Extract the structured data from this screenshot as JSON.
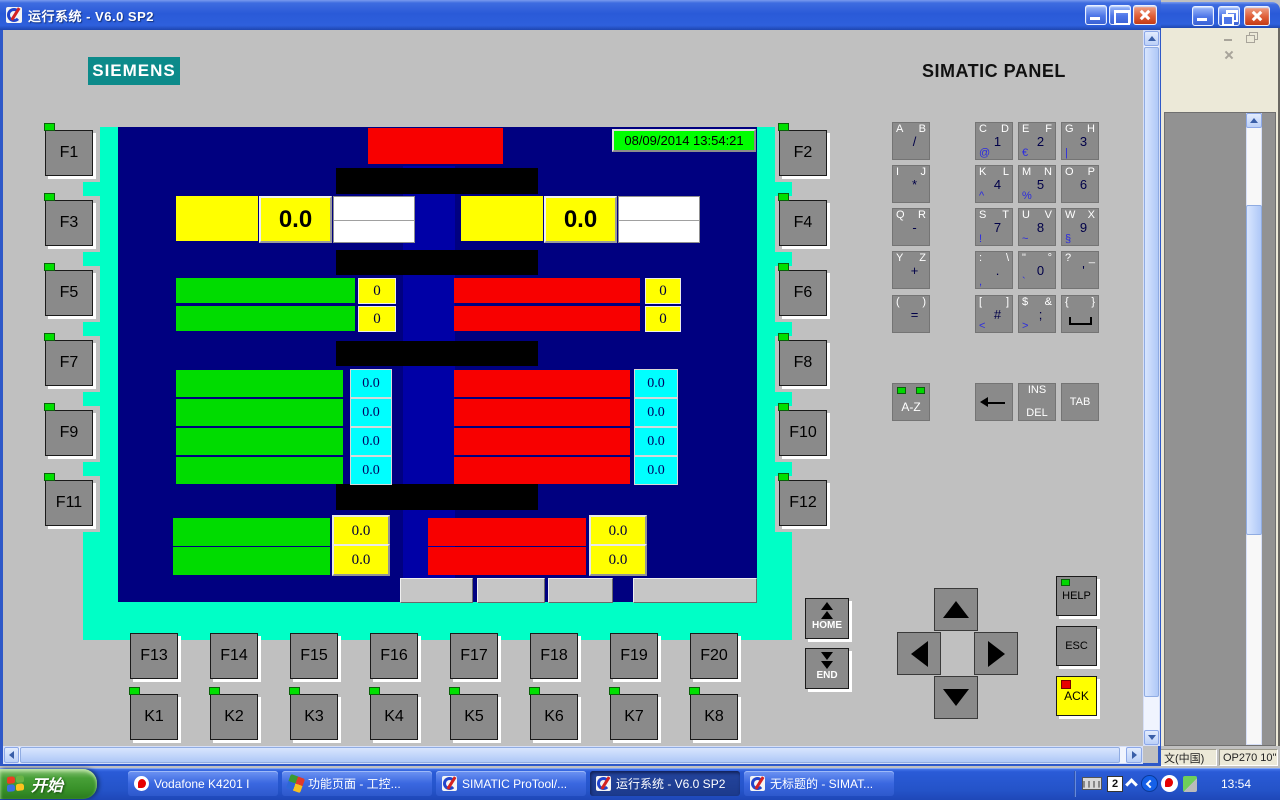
{
  "rt_window": {
    "title": "运行系统 - V6.0 SP2"
  },
  "bg_window": {
    "status_lang": "文(中国)",
    "status_device": "OP270 10\""
  },
  "header": {
    "brand": "SIEMENS",
    "panel_label": "SIMATIC PANEL"
  },
  "panel": {
    "f_left": [
      "F1",
      "F3",
      "F5",
      "F7",
      "F9",
      "F11"
    ],
    "f_right": [
      "F2",
      "F4",
      "F6",
      "F8",
      "F10",
      "F12"
    ],
    "f_bottom": [
      "F13",
      "F14",
      "F15",
      "F16",
      "F17",
      "F18",
      "F19",
      "F20"
    ],
    "k_keys": [
      "K1",
      "K2",
      "K3",
      "K4",
      "K5",
      "K6",
      "K7",
      "K8"
    ],
    "screen": {
      "datetime": "08/09/2014 13:54:21",
      "top_left_value": "0.0",
      "top_right_value": "0.0",
      "counters_left": [
        "0",
        "0"
      ],
      "counters_right": [
        "0",
        "0"
      ],
      "rates_left": [
        "0.0",
        "0.0",
        "0.0",
        "0.0"
      ],
      "rates_right": [
        "0.0",
        "0.0",
        "0.0",
        "0.0"
      ],
      "totals_left": [
        "0.0",
        "0.0"
      ],
      "totals_right": [
        "0.0",
        "0.0"
      ],
      "footer_buttons": [
        "",
        "",
        "",
        ""
      ]
    },
    "keypad": {
      "rows": [
        [
          {
            "tl": "A",
            "tr": "B",
            "mid": "/"
          },
          {
            "tl": "C",
            "tr": "D",
            "mid": "1",
            "bl": "@"
          },
          {
            "tl": "E",
            "tr": "F",
            "mid": "2",
            "bl": "€"
          },
          {
            "tl": "G",
            "tr": "H",
            "mid": "3",
            "bl": "|"
          }
        ],
        [
          {
            "tl": "I",
            "tr": "J",
            "mid": "*"
          },
          {
            "tl": "K",
            "tr": "L",
            "mid": "4",
            "bl": "^"
          },
          {
            "tl": "M",
            "tr": "N",
            "mid": "5",
            "bl": "%"
          },
          {
            "tl": "O",
            "tr": "P",
            "mid": "6"
          }
        ],
        [
          {
            "tl": "Q",
            "tr": "R",
            "mid": "-"
          },
          {
            "tl": "S",
            "tr": "T",
            "mid": "7",
            "bl": "!"
          },
          {
            "tl": "U",
            "tr": "V",
            "mid": "8",
            "bl": "~"
          },
          {
            "tl": "W",
            "tr": "X",
            "mid": "9",
            "bl": "§"
          }
        ],
        [
          {
            "tl": "Y",
            "tr": "Z",
            "mid": "+"
          },
          {
            "tl": ":",
            "tr": "\\",
            "mid": ".",
            "bl": ","
          },
          {
            "tl": "\"",
            "tr": "°",
            "mid": "0",
            "bl": "`"
          },
          {
            "tl": "?",
            "tr": "_",
            "mid": "'"
          }
        ],
        [
          {
            "tl": "(",
            "tr": ")",
            "mid": "="
          },
          {
            "tl": "[",
            "tr": "]",
            "mid": "#",
            "bl": "<"
          },
          {
            "tl": "$",
            "tr": "&",
            "mid": ";",
            "bl": ">"
          },
          {
            "tl": "{",
            "tr": "}",
            "space": true
          }
        ]
      ],
      "az_label": "A-Z",
      "ins_label": "INS",
      "del_label": "DEL",
      "tab_label": "TAB"
    },
    "nav": {
      "home": "HOME",
      "end": "END",
      "help": "HELP",
      "esc": "ESC",
      "ack": "ACK"
    }
  },
  "taskbar": {
    "start_label": "开始",
    "tasks": [
      {
        "label": "Vodafone K4201 I",
        "icon": "vodafone",
        "active": false
      },
      {
        "label": "功能页面 - 工控...",
        "icon": "wincc",
        "active": false
      },
      {
        "label": "SIMATIC ProTool/...",
        "icon": "protool",
        "active": false
      },
      {
        "label": "运行系统 - V6.0 SP2",
        "icon": "protool",
        "active": true
      },
      {
        "label": "无标题的 - SIMAT...",
        "icon": "protool",
        "active": false
      }
    ],
    "tray": {
      "input_label": "2",
      "clock": "13:54"
    }
  },
  "colors": {
    "bezel": "#00FFC6",
    "screen": "#000080",
    "screen_column": "#0000A6",
    "bar_green": "#00DC00",
    "bar_red": "#F80000",
    "value_yellow": "#FFFF00",
    "value_cyan": "#00FFFF",
    "datetime_bg": "#00FF00",
    "brand_teal": "#0C8A8A"
  }
}
